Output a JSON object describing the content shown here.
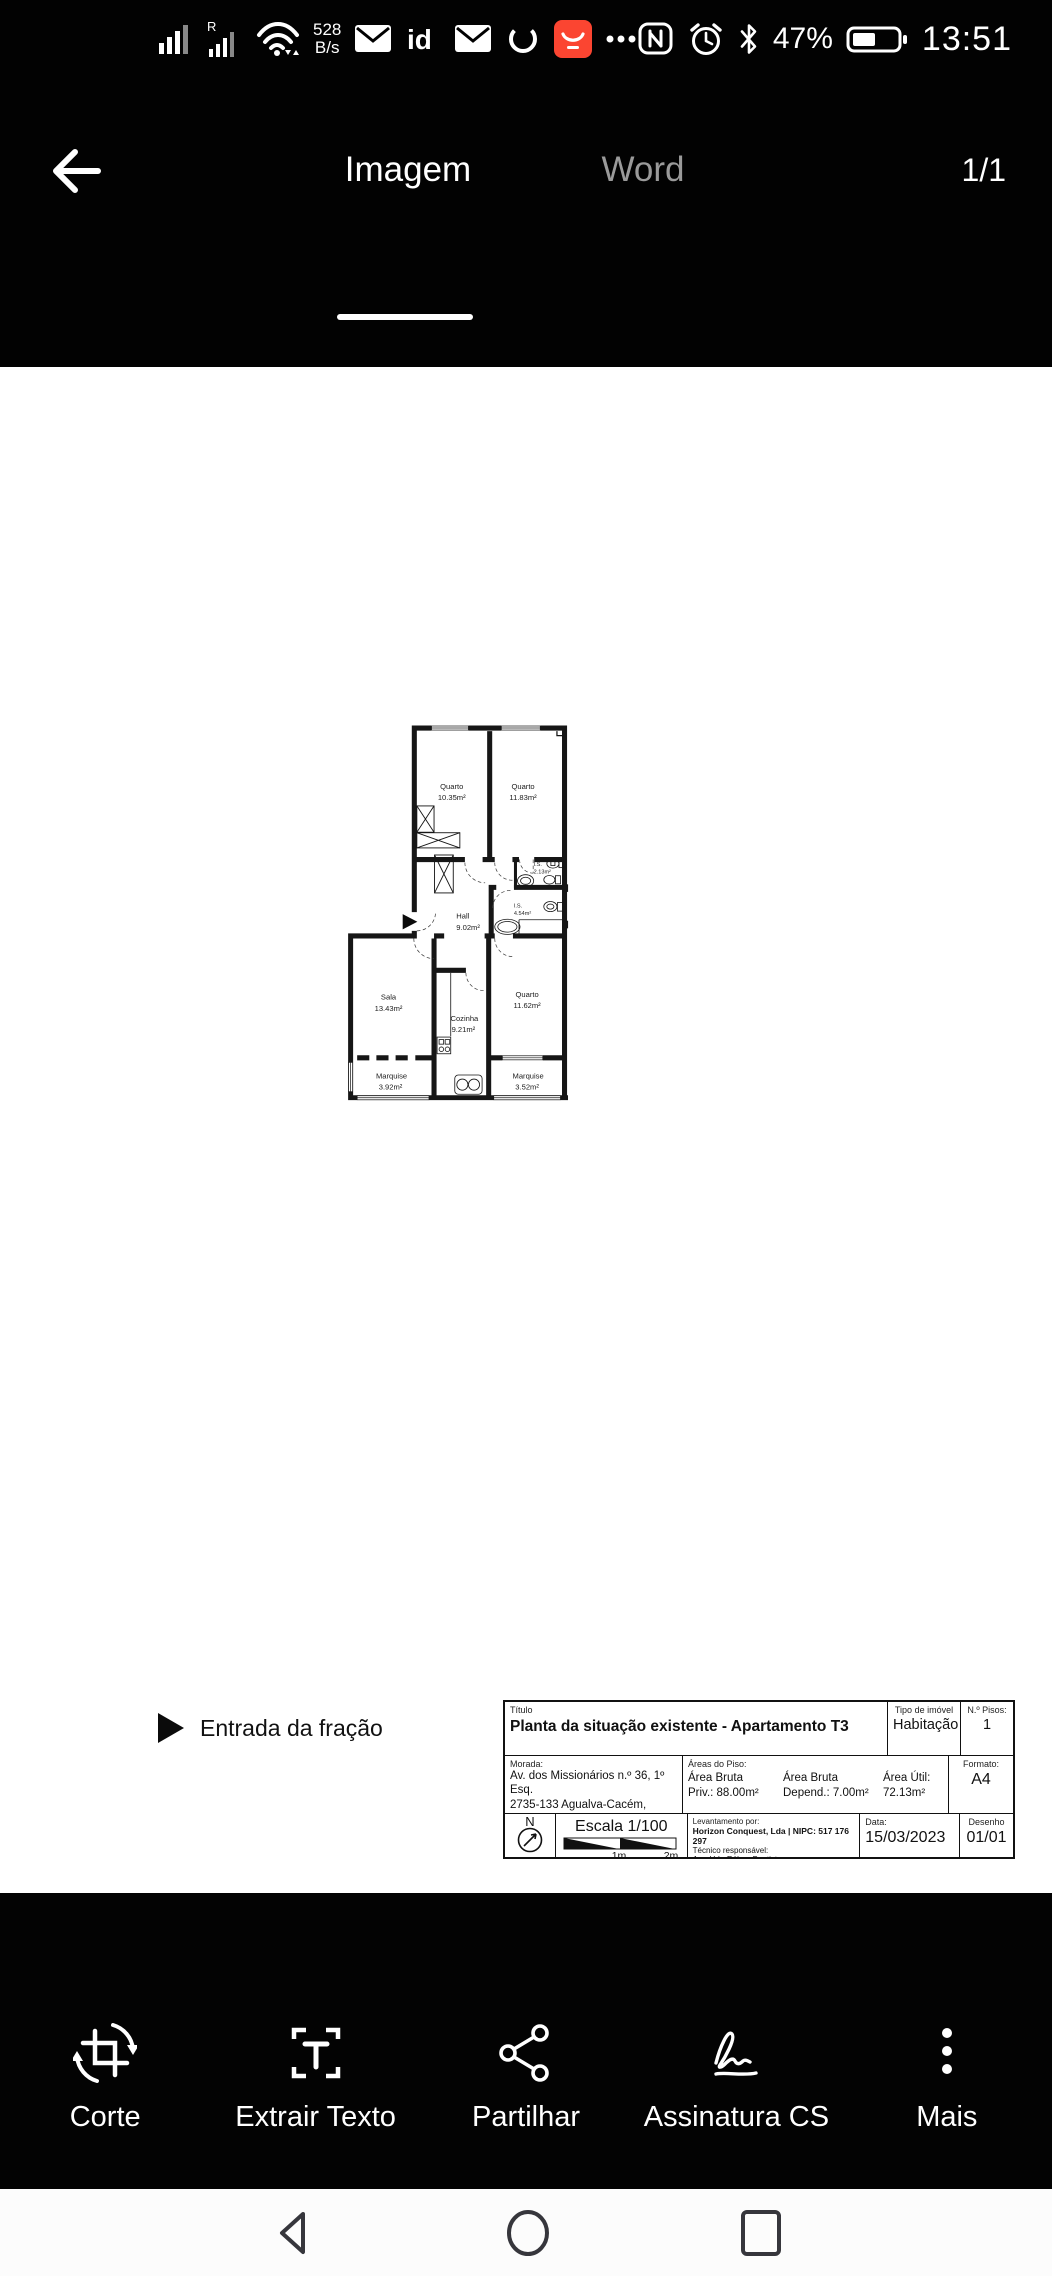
{
  "status_bar": {
    "network_speed_value": "528",
    "network_speed_unit": "B/s",
    "roaming_label": "R",
    "id_app_label": "id",
    "battery_percent": "47%",
    "time": "13:51"
  },
  "header": {
    "tabs": [
      {
        "label": "Imagem"
      },
      {
        "label": "Word"
      }
    ],
    "active_tab": "Imagem",
    "page_indicator": "1/1"
  },
  "document": {
    "entrance_legend": "Entrada da fração",
    "rooms": [
      {
        "name": "Quarto",
        "area": "10.35m²"
      },
      {
        "name": "Quarto",
        "area": "11.83m²"
      },
      {
        "name": "I.S.",
        "area": "2.13m²"
      },
      {
        "name": "I.S.",
        "area": "4.54m²"
      },
      {
        "name": "Hall",
        "area": "9.02m²"
      },
      {
        "name": "Sala",
        "area": "13.43m²"
      },
      {
        "name": "Cozinha",
        "area": "9.21m²"
      },
      {
        "name": "Quarto",
        "area": "11.62m²"
      },
      {
        "name": "Marquise",
        "area": "3.92m²"
      },
      {
        "name": "Marquise",
        "area": "3.52m²"
      }
    ],
    "title_block": {
      "title_label": "Título",
      "title": "Planta da situação existente - Apartamento T3",
      "type_label": "Tipo de imóvel",
      "type": "Habitação",
      "floors_label": "N.º Pisos:",
      "floors": "1",
      "address_label": "Morada:",
      "address_line1": "Av. dos Missionários n.º 36, 1º Esq.",
      "address_line2": "2735-133 Agualva-Cacém, Sintra",
      "areas_label": "Áreas do Piso:",
      "areas": [
        {
          "line1": "Área Bruta",
          "line2": "Priv.: 88.00m²"
        },
        {
          "line1": "Área Bruta",
          "line2": "Depend.: 7.00m²"
        },
        {
          "line1": "Área Útil:",
          "line2": "72.13m²"
        }
      ],
      "format_label": "Formato:",
      "format": "A4",
      "north_label": "N",
      "scale": "Escala 1/100",
      "scale_tick_1": "1m",
      "scale_tick_2": "2m",
      "survey_label": "Levantamento por:",
      "survey_company": "Horizon Conquest, Lda | NIPC: 517 176 297",
      "technician_label": "Técnico responsável:",
      "technician": "Arq. Urb. Rúben Baptista",
      "date_label": "Data:",
      "date": "15/03/2023",
      "drawing_label": "Desenho",
      "drawing": "01/01"
    }
  },
  "toolbar": {
    "items": [
      {
        "label": "Corte"
      },
      {
        "label": "Extrair Texto"
      },
      {
        "label": "Partilhar"
      },
      {
        "label": "Assinatura CS"
      },
      {
        "label": "Mais"
      }
    ]
  },
  "colors": {
    "chrome_bg": "#020202",
    "app_icon_red": "#fb4531",
    "inactive_tab": "#9a9a9a",
    "plan_ink": "#1c1c1c"
  }
}
